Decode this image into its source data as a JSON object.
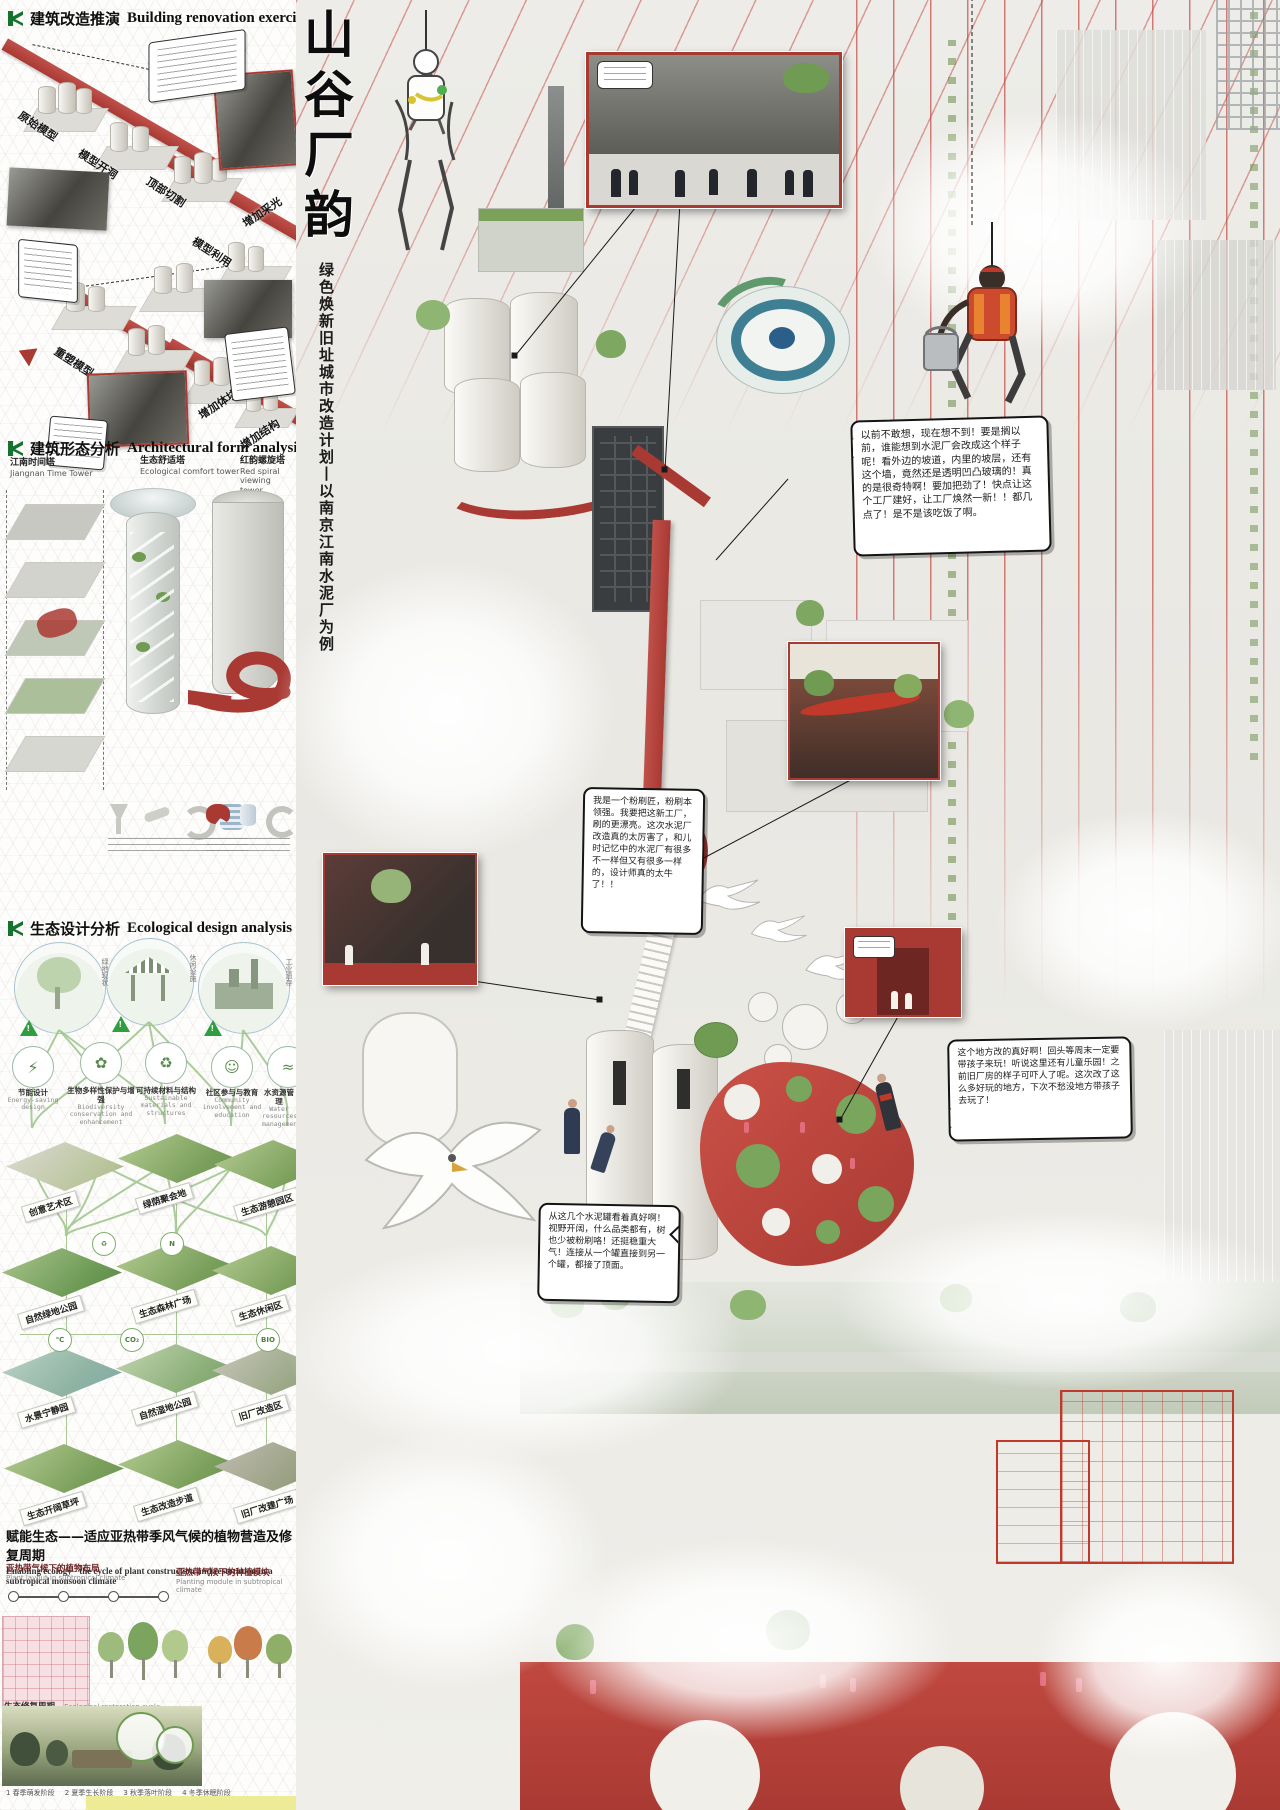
{
  "left": {
    "reno": {
      "title_zh": "建筑改造推演",
      "title_en": "Building renovation exercise",
      "steps": [
        "原始模型",
        "模型开洞",
        "顶部切割",
        "增加采光",
        "模型利用",
        "重塑模型",
        "顶部通透",
        "增加体块",
        "增加结构"
      ]
    },
    "form": {
      "title_zh": "建筑形态分析",
      "title_en": "Architectural form analysis",
      "towers": [
        {
          "zh": "江南时间塔",
          "en": "Jiangnan Time Tower"
        },
        {
          "zh": "生态舒适塔",
          "en": "Ecological comfort tower"
        },
        {
          "zh": "红韵螺旋塔",
          "en": "Red spiral viewing tower"
        }
      ]
    },
    "eco": {
      "title_zh": "生态设计分析",
      "title_en": "Ecological design analysis",
      "scene_labels": [
        "绿地现状",
        "休闲设施",
        "工业遗存"
      ],
      "nodes": [
        {
          "zh": "节能设计",
          "en": "Energy-saving design",
          "icon": "⚡"
        },
        {
          "zh": "生物多样性保护与增强",
          "en": "Biodiversity conservation and enhancement",
          "icon": "✿"
        },
        {
          "zh": "可持续材料与结构",
          "en": "Sustainable materials and structures",
          "icon": "♻"
        },
        {
          "zh": "社区参与与教育",
          "en": "Community involvement and education",
          "icon": "☺"
        },
        {
          "zh": "水资源管理",
          "en": "Water resources management",
          "icon": "≈"
        }
      ],
      "tiles": [
        [
          "创意艺术区",
          "绿荫聚会地",
          "生态游憩园区"
        ],
        [
          "自然绿地公园",
          "生态森林广场",
          "生态休闲区"
        ],
        [
          "水景宁静园",
          "自然湿地公园",
          "旧厂改造区"
        ],
        [
          "生态开阔草坪",
          "生态改造步道",
          "旧厂改建广场"
        ]
      ],
      "badges": [
        "℃",
        "CO₂",
        "BIO",
        "♻",
        "N"
      ]
    },
    "enabling": {
      "title_zh": "赋能生态——适应亚热带季风气候的植物营造及修复周期",
      "title_en": "Enabling ecology - the cycle of plant construction and restoration in a subtropical monsoon climate",
      "sub_left_zh": "亚热带气候下的植物布局",
      "sub_left_en": "Plant layout in subtropical climate",
      "sub_right_zh": "亚热带气候下的种植模块",
      "sub_right_en": "Planting module in subtropical climate",
      "cycle_zh": "生态修复周期",
      "cycle_en": "Ecological restoration cycle",
      "timeline": [
        "1 春季萌发阶段",
        "2 夏季生长阶段",
        "3 秋季落叶阶段",
        "4 冬季休眠阶段"
      ]
    }
  },
  "main": {
    "title_chars": [
      "山",
      "谷",
      "厂",
      "韵"
    ],
    "subtitle": "绿色焕新旧址城市改造计划丨以南京江南水泥厂为例",
    "bubbles": [
      "以前不敢想，现在想不到！要是搁以前，谁能想到水泥厂会改成这个样子呢！看外边的坡道，内里的坡层，还有这个墙，竟然还是透明凹凸玻璃的！真的是很奇特啊！要加把劲了！快点让这个工厂建好，让工厂焕然一新！！都几点了！是不是该吃饭了啊。",
      "我是一个粉刷匠，粉刷本领强。我要把这新工厂，刷的更漂亮。这次水泥厂改造真的太厉害了，和儿时记忆中的水泥厂有很多不一样但又有很多一样的，设计师真的太牛了！！",
      "这个地方改的真好啊！回头等周末一定要带孩子来玩！听说这里还有儿童乐园！之前旧厂房的样子可吓人了呢。这次改了这么多好玩的地方，下次不愁没地方带孩子去玩了！",
      "从这几个水泥罐看着真好啊！视野开阔，什么品类都有，树也少被粉刷咯！还挺稳重大气！连接从一个罐直接到另一个罐，都接了顶面。"
    ],
    "colors": {
      "accent_red": "#a93a33",
      "grid_red": "#c23b33",
      "eco_green": "#7ba05c"
    }
  }
}
